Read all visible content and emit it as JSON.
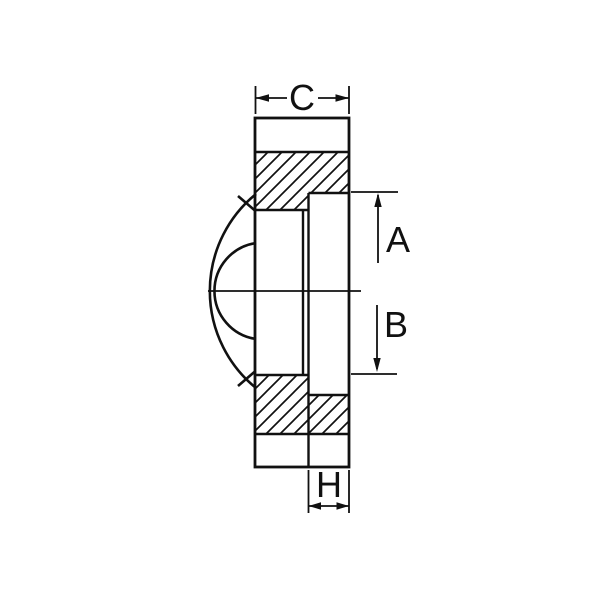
{
  "drawing": {
    "kind": "mechanical cross-section with ball profile",
    "colors": {
      "background": "#ffffff",
      "line": "#111111"
    },
    "dimensions": [
      {
        "label": "C",
        "position": "top",
        "axis": "horizontal"
      },
      {
        "label": "A",
        "position": "right-upper",
        "axis": "vertical"
      },
      {
        "label": "B",
        "position": "right-lower",
        "axis": "vertical"
      },
      {
        "label": "H",
        "position": "bottom",
        "axis": "horizontal"
      }
    ]
  }
}
